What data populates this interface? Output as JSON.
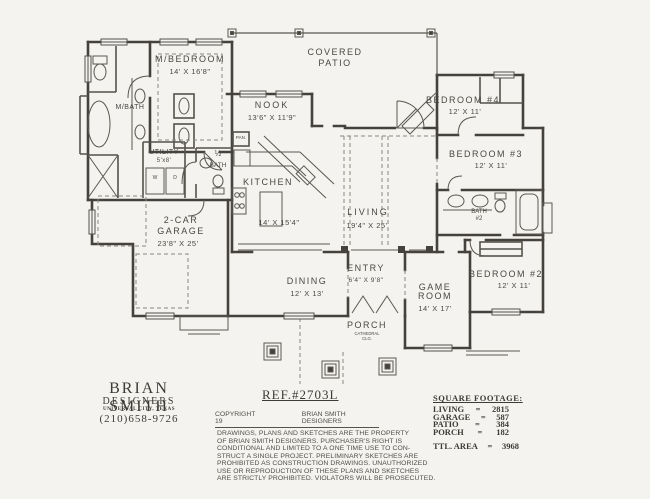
{
  "rooms": {
    "m_bedroom": {
      "name": "M/BEDROOM",
      "dims": "14' X 16'8\""
    },
    "m_bath": {
      "name": "M/BATH"
    },
    "utility": {
      "name": "UTILITY",
      "dims": "5'x8'"
    },
    "half_bath": {
      "fraction": "½",
      "name": "BATH"
    },
    "pantry": {
      "name": "PAN."
    },
    "washer": {
      "name": "W"
    },
    "dryer": {
      "name": "D"
    },
    "nook": {
      "name": "NOOK",
      "dims": "13'6\" X 11'9\""
    },
    "covered_patio": {
      "line1": "COVERED",
      "line2": "PATIO"
    },
    "kitchen": {
      "name": "KITCHEN",
      "dims": "14' X 15'4\""
    },
    "living": {
      "name": "LIVING",
      "dims": "19'4\" X 25'"
    },
    "garage": {
      "line1": "2-CAR",
      "line2": "GARAGE",
      "dims": "23'8\" X 25'"
    },
    "dining": {
      "name": "DINING",
      "dims": "12' X 13'"
    },
    "entry": {
      "name": "ENTRY",
      "dims": "6'4\" X 9'8\""
    },
    "game_room": {
      "line1": "GAME",
      "line2": "ROOM",
      "dims": "14' X 17'"
    },
    "porch": {
      "name": "PORCH",
      "sub": "CATHEDRAL CLG."
    },
    "bedroom4": {
      "name": "BEDROOM #4",
      "dims": "12' X 11'"
    },
    "bedroom3": {
      "name": "BEDROOM #3",
      "dims": "12' X 11'"
    },
    "bedroom2": {
      "name": "BEDROOM #2",
      "dims": "12' X 11'"
    },
    "bath2": {
      "line1": "BATH",
      "line2": "#2"
    }
  },
  "designer": {
    "name": "BRIAN SMITH",
    "title": "DESIGNERS",
    "city": "UNIVERSAL CITY, TEXAS",
    "phone": "(210)658-9726"
  },
  "ref": "REF.#2703L",
  "copyright": {
    "label": "COPYRIGHT 19",
    "owner": "BRIAN SMITH DESIGNERS",
    "lines": [
      "DRAWINGS, PLANS AND SKETCHES ARE THE PROPERTY",
      "OF BRIAN SMITH DESIGNERS.  PURCHASER'S RIGHT IS",
      "CONDITIONAL AND LIMITED TO A ONE TIME USE TO CON-",
      "STRUCT A SINGLE PROJECT.  PRELIMINARY SKETCHES ARE",
      "PROHIBITED AS CONSTRUCTION DRAWINGS.  UNAUTHORIZED",
      "USE OR REPRODUCTION OF THESE PLANS AND SKETCHES",
      "ARE STRICTLY PROHIBITED.  VIOLATORS WILL BE PROSECUTED."
    ]
  },
  "square_footage": {
    "heading": "SQUARE FOOTAGE:",
    "eq": "=",
    "rows": [
      {
        "label": "LIVING",
        "value": "2815"
      },
      {
        "label": "GARAGE",
        "value": "587"
      },
      {
        "label": "PATIO",
        "value": "384"
      },
      {
        "label": "PORCH",
        "value": "182"
      }
    ],
    "total_label": "TTL. AREA",
    "total_value": "3968"
  }
}
